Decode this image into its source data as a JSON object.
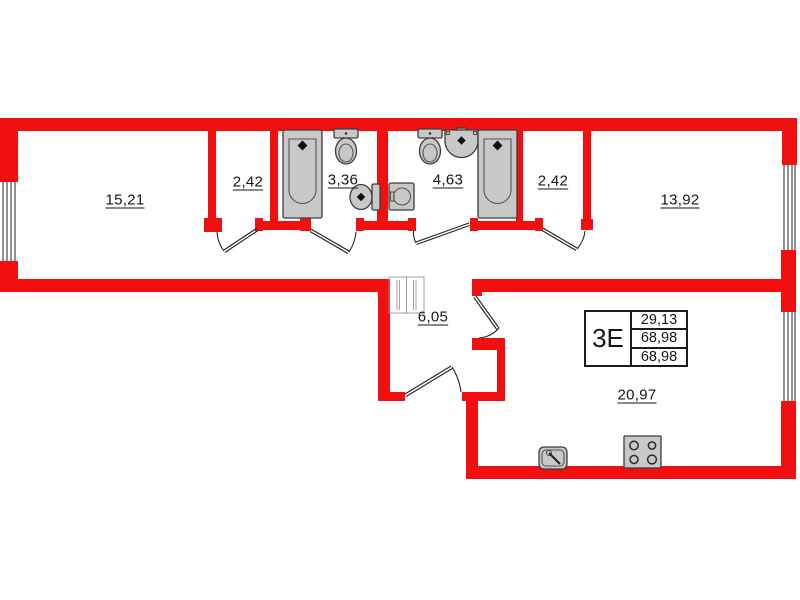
{
  "colors": {
    "wall": "#f20f0f",
    "fixture_fill": "#c8c8c8",
    "fixture_stroke": "#3c3c3c",
    "line": "#222222"
  },
  "unit": {
    "type_label": "3Е",
    "rows": [
      "29,13",
      "68,98",
      "68,98"
    ]
  },
  "rooms": [
    {
      "id": "room-left",
      "area": "15,21"
    },
    {
      "id": "closet-left",
      "area": "2,42"
    },
    {
      "id": "bathroom-small",
      "area": "3,36"
    },
    {
      "id": "bathroom-large",
      "area": "4,63"
    },
    {
      "id": "closet-right",
      "area": "2,42"
    },
    {
      "id": "room-right",
      "area": "13,92"
    },
    {
      "id": "hallway",
      "area": "6,05"
    },
    {
      "id": "kitchen-living",
      "area": "20,97"
    }
  ]
}
